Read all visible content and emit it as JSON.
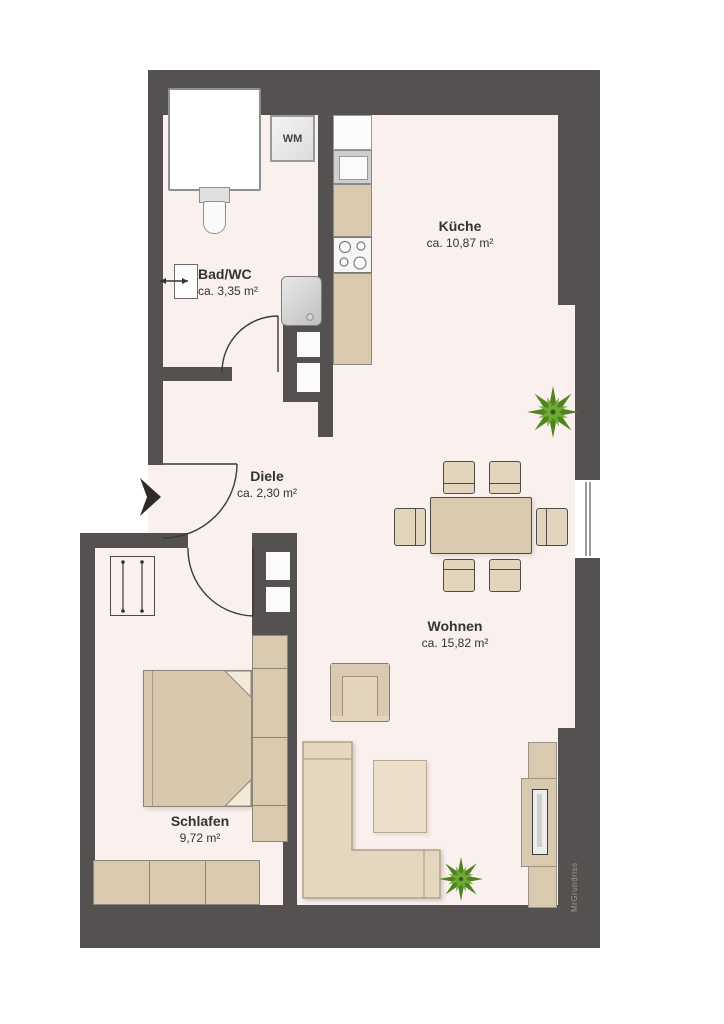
{
  "plan": {
    "rooms": [
      {
        "name": "Küche",
        "area": "ca. 10,87 m²"
      },
      {
        "name": "Bad/WC",
        "area": "ca. 3,35 m²"
      },
      {
        "name": "Diele",
        "area": "ca. 2,30 m²"
      },
      {
        "name": "Wohnen",
        "area": "ca. 15,82 m²"
      },
      {
        "name": "Schlafen",
        "area": "9,72 m²"
      }
    ],
    "appliance_labels": {
      "washing_machine": "WM"
    },
    "watermark": "MrGrundriss",
    "colors": {
      "outside": "#ffffff",
      "floor": "#faf0ee",
      "wall": "#555150",
      "furniture_beige": "#d9c9ae",
      "furniture_light": "#e3d4bd",
      "sanitary_border": "#8f8f8f",
      "plant_dark": "#4e8420",
      "plant_light": "#6fa832",
      "text": "#333333",
      "watermark_text": "#9b9795"
    }
  }
}
